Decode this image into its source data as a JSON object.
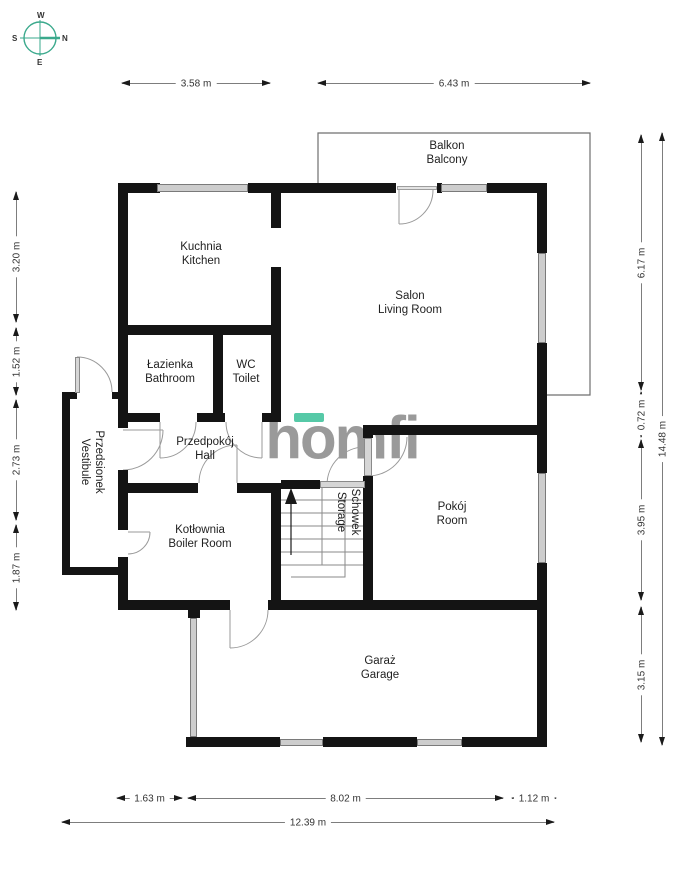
{
  "compass": {
    "n": "N",
    "s": "S",
    "e": "E",
    "w": "W"
  },
  "brand": {
    "logo_text": "homfi"
  },
  "colors": {
    "accent_teal": "#3aa98c",
    "logo_gray": "#9a9a9a",
    "wall": "#141414",
    "window_fill": "#cdcdcd"
  },
  "rooms": {
    "balkon": {
      "pl": "Balkon",
      "en": "Balcony"
    },
    "kuchnia": {
      "pl": "Kuchnia",
      "en": "Kitchen"
    },
    "salon": {
      "pl": "Salon",
      "en": "Living Room"
    },
    "lazienka": {
      "pl": "Łazienka",
      "en": "Bathroom"
    },
    "wc": {
      "pl": "WC",
      "en": "Toilet"
    },
    "przedsionek": {
      "pl": "Przedsionek",
      "en": "Vestibule"
    },
    "przedpokoj": {
      "pl": "Przedpokój",
      "en": "Hall"
    },
    "kotlownia": {
      "pl": "Kotłownia",
      "en": "Boiler Room"
    },
    "schowek": {
      "pl": "Schowek",
      "en": "Storage"
    },
    "pokoj": {
      "pl": "Pokój",
      "en": "Room"
    },
    "garaz": {
      "pl": "Garaż",
      "en": "Garage"
    }
  },
  "dimensions": {
    "top": [
      {
        "label": "3.58 m"
      },
      {
        "label": "6.43 m"
      }
    ],
    "left": [
      {
        "label": "3.20 m"
      },
      {
        "label": "1.52 m"
      },
      {
        "label": "2.73 m"
      },
      {
        "label": "1.87 m"
      }
    ],
    "right_inner": [
      {
        "label": "6.17 m"
      },
      {
        "label": "0.72 m"
      },
      {
        "label": "3.95 m"
      },
      {
        "label": "3.15 m"
      }
    ],
    "right_outer": [
      {
        "label": "14.48 m"
      }
    ],
    "bottom_inner": [
      {
        "label": "1.63 m"
      },
      {
        "label": "8.02 m"
      },
      {
        "label": "1.12 m"
      }
    ],
    "bottom_outer": [
      {
        "label": "12.39 m"
      }
    ]
  }
}
